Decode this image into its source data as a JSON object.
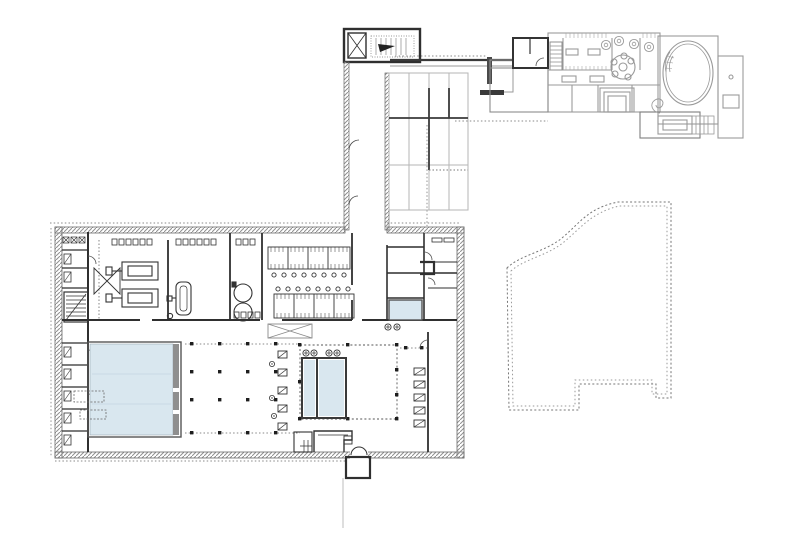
{
  "plan": {
    "kind": "architectural-floor-plan",
    "canvas": {
      "width": 800,
      "height": 533
    },
    "colors": {
      "background": "#ffffff",
      "wall_dark": "#2f2f2f",
      "wall_hatch": "#8f8f8f",
      "wall_hatch_edge": "#6a6a6a",
      "existing_building": "#9a9a9a",
      "water": "#d9e7ef",
      "water_edge": "#8a9aa6",
      "lane_line": "#c3d4e0",
      "pool_deck": "#8f8f8f",
      "dashed_line": "#777777",
      "dotted_line": "#888888",
      "column": "#1e1e1e",
      "furniture": "#444444",
      "light_line": "#b5b5b5"
    },
    "features": [
      {
        "id": "main-building",
        "label": "main bath building (new, hatched walls)"
      },
      {
        "id": "main-pool",
        "label": "large swimming pool"
      },
      {
        "id": "teaching-pools",
        "label": "two small pools with showers"
      },
      {
        "id": "plunge-pool",
        "label": "small plunge pool"
      },
      {
        "id": "corridor-link",
        "label": "linking corridor with stair and elevator"
      },
      {
        "id": "glazed-court",
        "label": "gridded court / skylight structure"
      },
      {
        "id": "historic-wing",
        "label": "existing historic wing with oval hall"
      },
      {
        "id": "oval-hall",
        "label": "oval hall with curved stair"
      },
      {
        "id": "garden-outline",
        "label": "dashed terrace / roof outline"
      },
      {
        "id": "entrance-vestibule",
        "label": "entrance vestibule with arched door"
      },
      {
        "id": "column-grid",
        "label": "pool hall column grid"
      }
    ]
  }
}
